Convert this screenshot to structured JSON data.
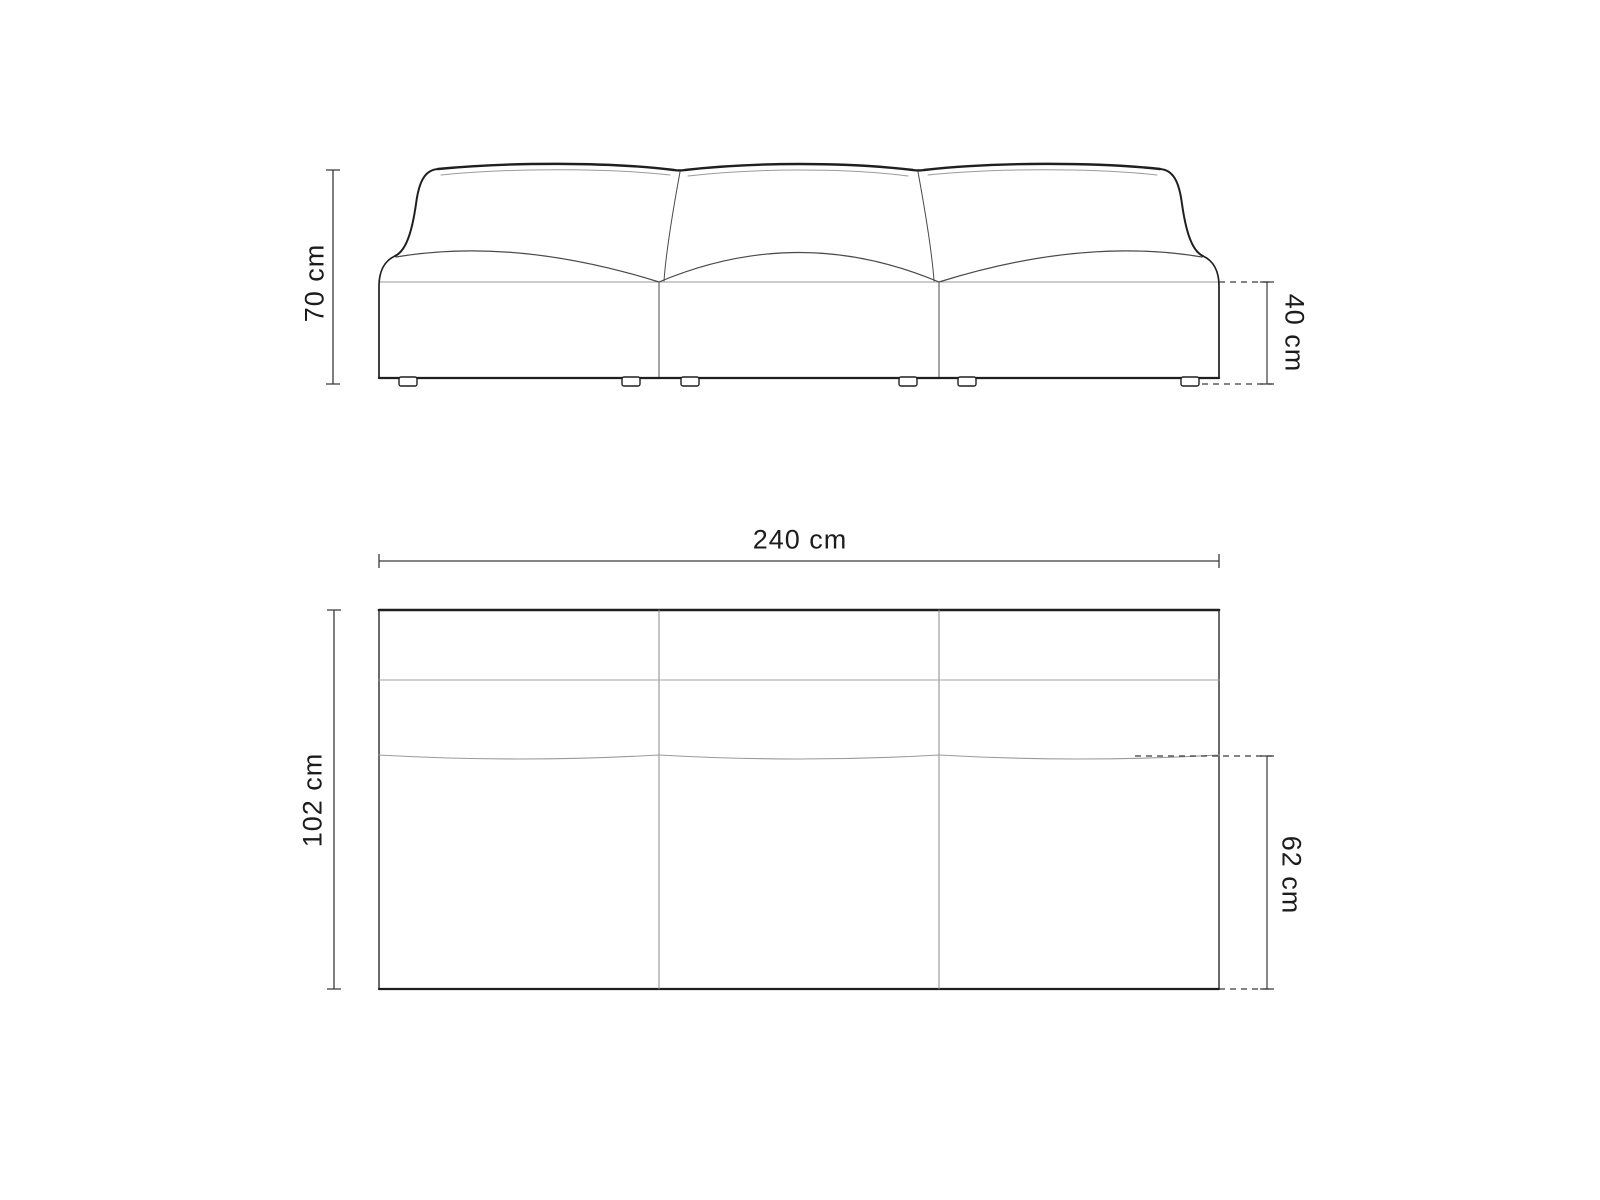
{
  "diagram": {
    "subject": "sofa-dimension-drawing",
    "views": {
      "front_elevation": {
        "dimensions": {
          "overall_height": {
            "label": "70 cm"
          },
          "seat_height": {
            "label": "40 cm"
          }
        }
      },
      "top_plan": {
        "dimensions": {
          "overall_width": {
            "label": "240 cm"
          },
          "overall_depth": {
            "label": "102 cm"
          },
          "seat_depth": {
            "label": "62 cm"
          }
        }
      }
    },
    "colors": {
      "background": "#ffffff",
      "outline_dark": "#1f1f1f",
      "outline_mid": "#4a4a4a",
      "outline_light": "#9a9a9a",
      "dimension_line": "#3a3a3a",
      "label_text": "#1c1c1c"
    }
  }
}
